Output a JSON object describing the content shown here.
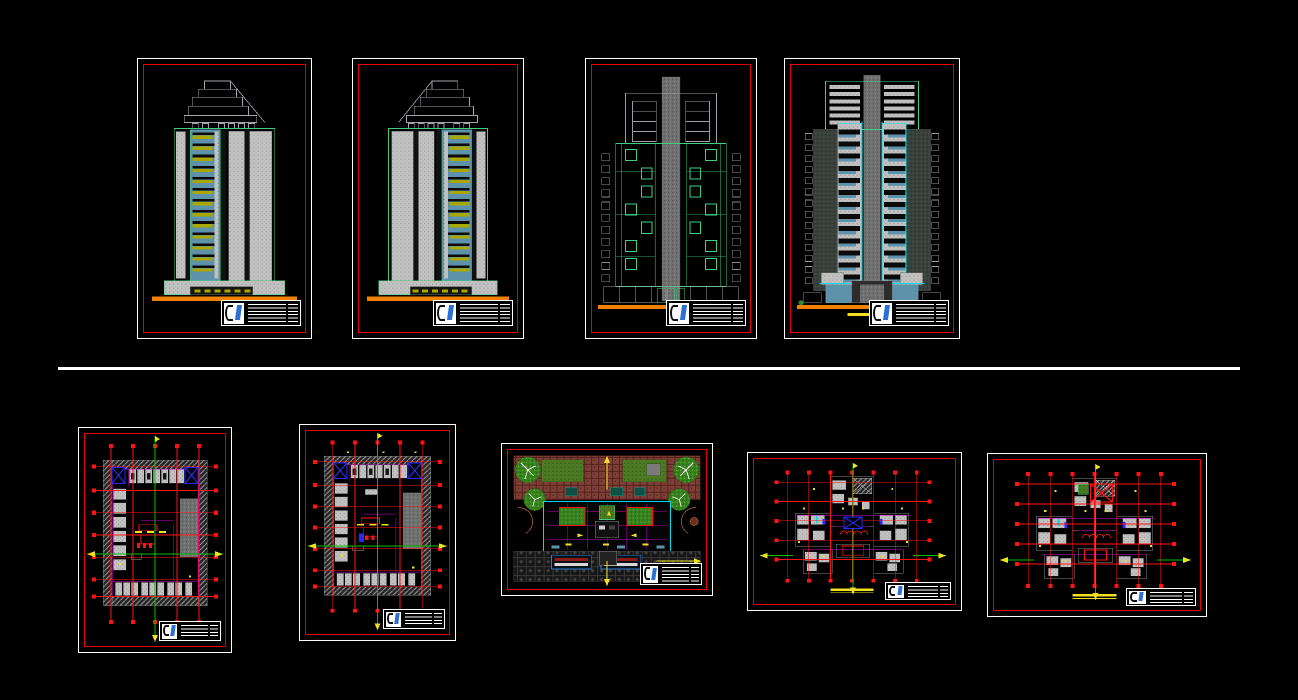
{
  "app": {
    "type": "cad-model-space-view",
    "background": "#000000"
  },
  "layout": {
    "rows": 2,
    "divider": {
      "orientation": "horizontal"
    }
  },
  "colors": {
    "background": "#000000",
    "frame_white": "#ffffff",
    "frame_red": "#e60000",
    "grid_red": "#ff1212",
    "orange_ground": "#f08200",
    "olive_balcony": "#a8a800",
    "steel_blue": "#5d92aa",
    "cyan_accent": "#00dce8",
    "green_outline": "#3fcf7f",
    "axis_green": "#00c000",
    "magenta_wall": "#cc00cc",
    "blue_symbol": "#2929ff",
    "yellow_mark": "#f0e020",
    "lawn_green": "#4c7a22",
    "tree_green": "#35821f",
    "paving_brown": "#7c4036",
    "paving_dark": "#161616",
    "gray_light": "#c2c2c2",
    "gray_core": "#707070",
    "gray_dark": "#39413b",
    "title_blue": "#2e6fd4"
  },
  "sheets": [
    {
      "id": "elevation-1",
      "kind": "building-elevation",
      "orientation": "portrait",
      "row": "top"
    },
    {
      "id": "elevation-2",
      "kind": "building-elevation-mirrored",
      "orientation": "portrait",
      "row": "top"
    },
    {
      "id": "elevation-3",
      "kind": "building-elevation-core",
      "orientation": "portrait",
      "row": "top"
    },
    {
      "id": "elevation-4",
      "kind": "building-elevation-glazed",
      "orientation": "portrait",
      "row": "top"
    },
    {
      "id": "floor-plan-1",
      "kind": "floor-plan-courtyard",
      "orientation": "portrait",
      "row": "bottom"
    },
    {
      "id": "floor-plan-2",
      "kind": "floor-plan-courtyard",
      "orientation": "portrait",
      "row": "bottom"
    },
    {
      "id": "site-plan",
      "kind": "landscape-site-plan",
      "orientation": "landscape",
      "row": "bottom"
    },
    {
      "id": "typical-plan-1",
      "kind": "tower-typical-floor-plan",
      "orientation": "landscape",
      "row": "bottom"
    },
    {
      "id": "typical-plan-2",
      "kind": "tower-roof-plan",
      "orientation": "landscape",
      "row": "bottom"
    }
  ]
}
